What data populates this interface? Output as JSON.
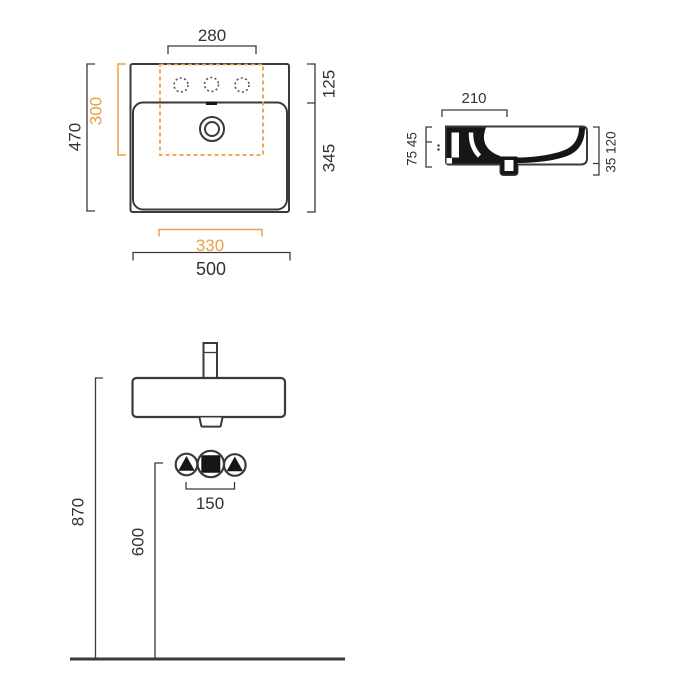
{
  "drawing": {
    "kind": "washbasin-technical-drawing",
    "colors": {
      "line": "#3a3a3a",
      "section_fill": "#161616",
      "accent_orange": "#e8a04a",
      "text": "#333333",
      "background": "#ffffff"
    },
    "plan_view": {
      "width_tap_deck": "280",
      "depth_overall": "470",
      "depth_bowl_cutout": "300",
      "depth_deck": "125",
      "depth_bowl": "345",
      "width_bowl_cutout": "330",
      "width_overall": "500"
    },
    "section_view": {
      "depth_tap_deck": "210",
      "heights_left": "75 45",
      "heights_right": "35 120"
    },
    "front_view": {
      "height_rim_from_floor": "870",
      "height_drain_from_floor": "600",
      "spacing_supply_holes": "150"
    }
  }
}
